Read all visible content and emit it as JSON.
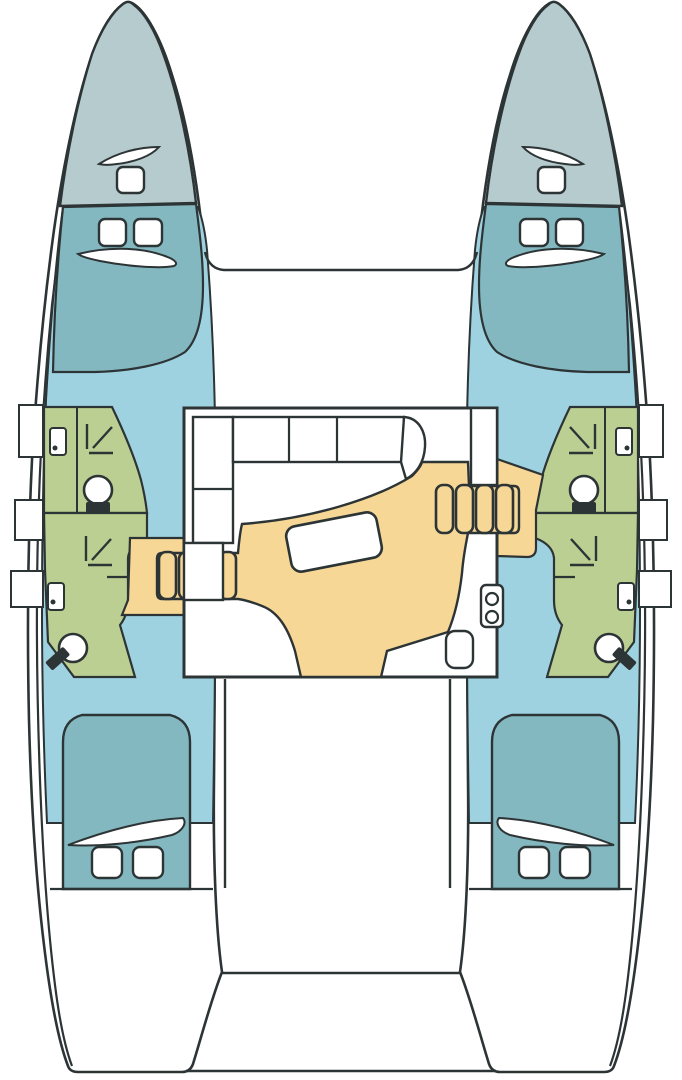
{
  "diagram": {
    "type": "boat-floor-plan",
    "subject": "catamaran-4-cabin-4-head-layout",
    "canvas": {
      "width": 682,
      "height": 1080
    },
    "colors": {
      "background": "#ffffff",
      "outline": "#2d3436",
      "bow_deck": "#b6cbcd",
      "cabin_teal": "#84b8c0",
      "corridor_blue": "#9fd2e0",
      "bathroom_green": "#bccf92",
      "salon_floor_yellow": "#f6d795",
      "furniture_white": "#ffffff"
    },
    "areas": {
      "port_hull": [
        "bow-deck",
        "forward-cabin",
        "corridor",
        "upper-bathroom",
        "lower-bathroom",
        "aft-cabin",
        "transom-steps"
      ],
      "starboard_hull": [
        "bow-deck",
        "forward-cabin",
        "corridor",
        "upper-bathroom",
        "lower-bathroom",
        "aft-cabin",
        "transom-steps"
      ],
      "center": [
        "foredeck-trampoline",
        "salon",
        "galley",
        "nav-station",
        "cockpit",
        "aft-platform"
      ]
    },
    "fixtures": {
      "per_bathroom": [
        "sink-icon",
        "shower-icon",
        "toilet-icon"
      ],
      "per_cabin": [
        "double-bed",
        "pillow",
        "hatch-window"
      ],
      "salon": [
        "l-shaped-sofa",
        "dining-table",
        "companionway-steps",
        "stove-icon",
        "sink-icon"
      ]
    },
    "counts": {
      "cabins": 4,
      "bathrooms": 4,
      "hatches": 10,
      "companionway_steps": 2
    }
  }
}
